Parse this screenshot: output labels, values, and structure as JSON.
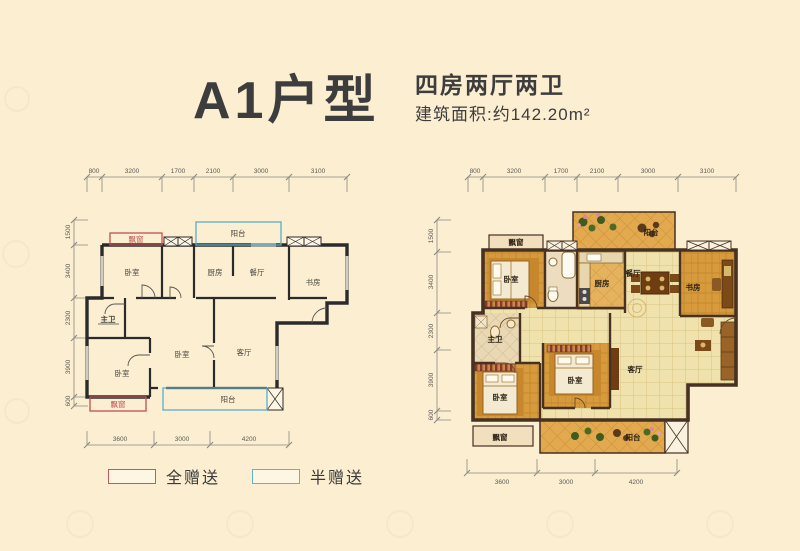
{
  "header": {
    "title": "A1户型",
    "layout_type": "四房两厅两卫",
    "area": "建筑面积:约142.20m²"
  },
  "legend": {
    "full_gift": "全赠送",
    "half_gift": "半赠送"
  },
  "colors": {
    "full_gift_border": "#c25b5b",
    "half_gift_border": "#62b0c9",
    "background": "#fbeed1",
    "schematic_wall": "#2b2b2b",
    "colored_wall": "#463122",
    "wood_floor": "#d79a3c",
    "tile_floor": "#f0e2ac"
  },
  "dims": {
    "top": [
      "800",
      "3200",
      "1700",
      "2100",
      "3000",
      "3100"
    ],
    "left": [
      "1500",
      "3400",
      "2300",
      "3900",
      "600"
    ],
    "bottom": [
      "3600",
      "3000",
      "4200"
    ]
  },
  "left_plan": {
    "rooms": {
      "bay_top": "飘窗",
      "balcony_top": "阳台",
      "bedroom1": "卧室",
      "kitchen": "厨房",
      "dining": "餐厅",
      "study": "书房",
      "master_bath": "主卫",
      "bedroom2": "卧室",
      "bedroom3": "卧室",
      "living": "客厅",
      "bay_bottom": "飘窗",
      "balcony_bottom": "阳台"
    }
  },
  "right_plan": {
    "rooms": {
      "bay_top": "飘窗",
      "balcony_top": "阳台",
      "bedroom1": "卧室",
      "kitchen": "厨房",
      "dining": "餐厅",
      "study": "书房",
      "master_bath": "主卫",
      "bedroom2": "卧室",
      "bedroom3": "卧室",
      "living": "客厅",
      "bay_bottom": "飘窗",
      "balcony_bottom": "阳台"
    }
  }
}
